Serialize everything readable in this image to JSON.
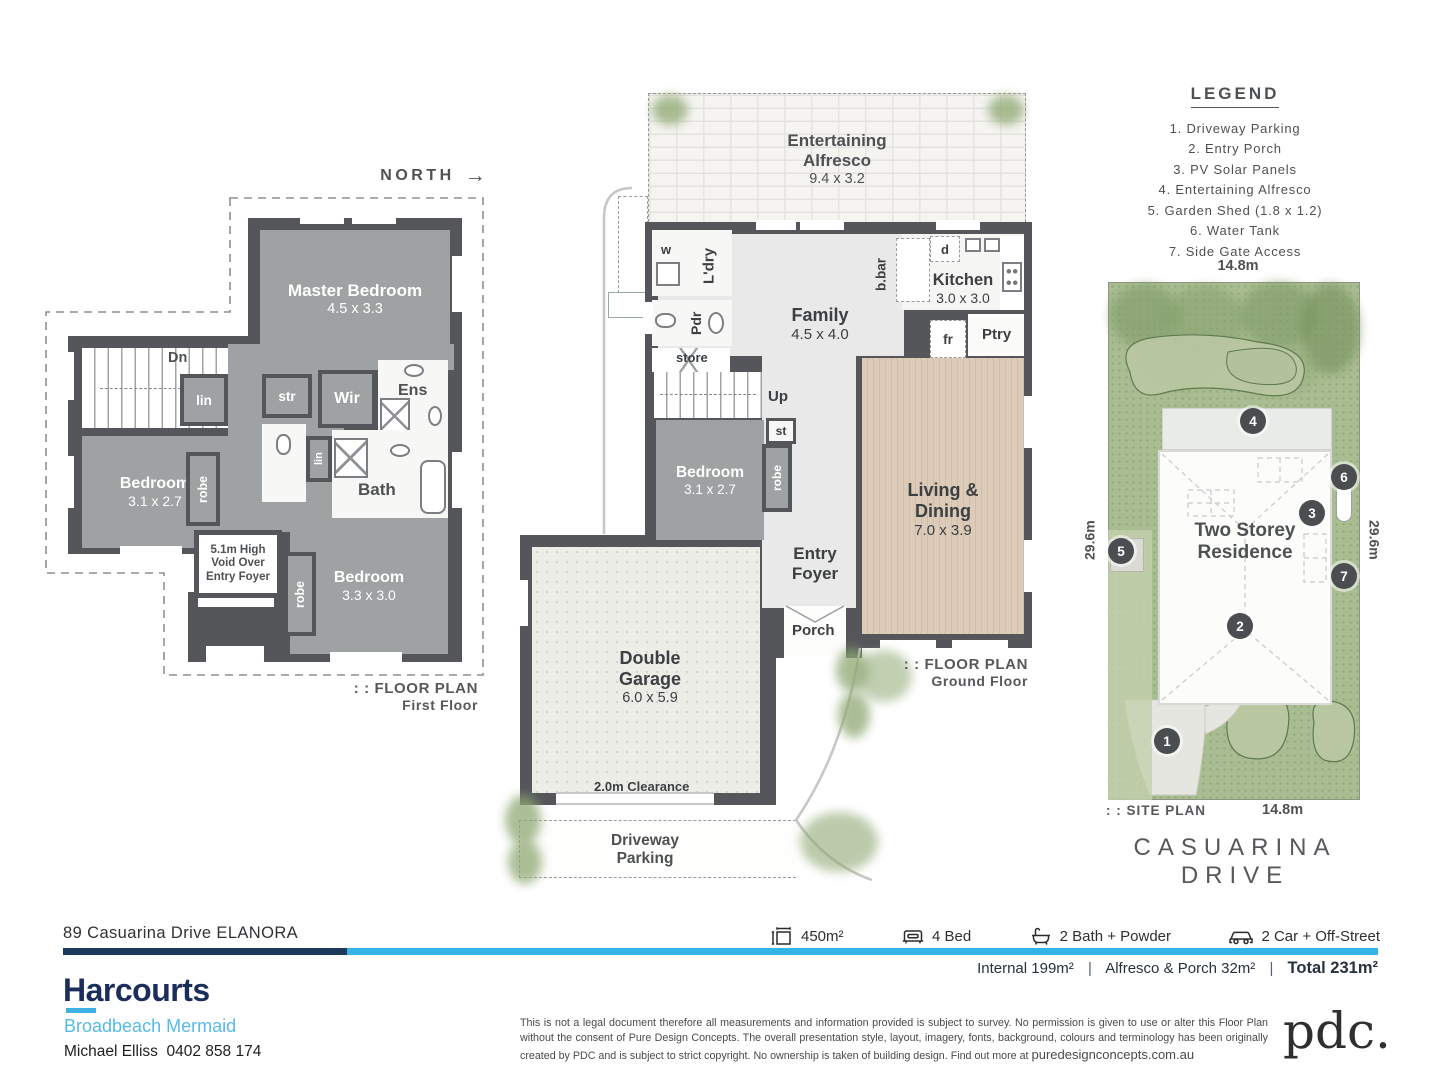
{
  "legend": {
    "title": "LEGEND",
    "items": [
      "1. Driveway Parking",
      "2. Entry Porch",
      "3. PV Solar Panels",
      "4. Entertaining Alfresco",
      "5. Garden Shed (1.8 x 1.2)",
      "6. Water Tank",
      "7. Side Gate Access"
    ]
  },
  "first_floor": {
    "north_label": "NORTH",
    "north_arrow": "→",
    "master_name": "Master Bedroom",
    "master_dim": "4.5 x 3.3",
    "dn": "Dn",
    "lin1": "lin",
    "str": "str",
    "wir": "Wir",
    "ens": "Ens",
    "bed1_name": "Bedroom",
    "bed1_dim": "3.1 x 2.7",
    "robe1": "robe",
    "lin2": "lin",
    "bath": "Bath",
    "void_l1": "5.1m High",
    "void_l2": "Void Over",
    "void_l3": "Entry Foyer",
    "bed2_name": "Bedroom",
    "bed2_dim": "3.3 x 3.0",
    "robe2": "robe",
    "plan_tag": ": : FLOOR PLAN",
    "plan_floor": "First Floor"
  },
  "ground_floor": {
    "alfresco_l1": "Entertaining",
    "alfresco_l2": "Alfresco",
    "alfresco_dim": "9.4 x 3.2",
    "w": "w",
    "ldry": "L'dry",
    "pdr": "Pdr",
    "store": "store",
    "family_name": "Family",
    "family_dim": "4.5 x 4.0",
    "bbar": "b.bar",
    "d": "d",
    "kitchen_name": "Kitchen",
    "kitchen_dim": "3.0 x 3.0",
    "fr": "fr",
    "ptry": "Ptry",
    "up": "Up",
    "st": "st",
    "robe": "robe",
    "bed_name": "Bedroom",
    "bed_dim": "3.1 x 2.7",
    "living_l1": "Living &",
    "living_l2": "Dining",
    "living_dim": "7.0 x 3.9",
    "entry_l1": "Entry",
    "entry_l2": "Foyer",
    "porch": "Porch",
    "garage_l1": "Double",
    "garage_l2": "Garage",
    "garage_dim": "6.0 x 5.9",
    "clearance": "2.0m Clearance",
    "driveway_l1": "Driveway",
    "driveway_l2": "Parking",
    "plan_tag": ": : FLOOR PLAN",
    "plan_floor": "Ground Floor"
  },
  "site_plan": {
    "width_top": "14.8m",
    "width_bottom": "14.8m",
    "depth_left": "29.6m",
    "depth_right": "29.6m",
    "residence_l1": "Two Storey",
    "residence_l2": "Residence",
    "markers": [
      "1",
      "2",
      "3",
      "4",
      "5",
      "6",
      "7"
    ],
    "plan_tag": ": : SITE PLAN",
    "street": "CASUARINA DRIVE"
  },
  "footer": {
    "address": "89 Casuarina Drive ELANORA",
    "stats": [
      {
        "icon": "land-size-icon",
        "label": "450m²"
      },
      {
        "icon": "bed-icon",
        "label": "4 Bed"
      },
      {
        "icon": "bath-icon",
        "label": "2 Bath + Powder"
      },
      {
        "icon": "car-icon",
        "label": "2 Car + Off-Street"
      }
    ],
    "area_internal": "Internal 199m²",
    "area_alfresco": "Alfresco & Porch 32m²",
    "area_total": "Total 231m²",
    "sep": "|",
    "brand": "Harcourts",
    "brand_sub": "Broadbeach Mermaid",
    "agent": "Michael Elliss  0402 858 174",
    "disclaimer": "This is not a legal document therefore all measurements and information provided is subject to survey. No permission is given to use or alter this Floor Plan without the consent of Pure Design Concepts. The overall presentation style, layout, imagery, fonts, background, colours and terminology has been originally created by PDC and is subject to strict copyright. No ownership is taken of building design. Find out more at ",
    "disclaimer_url": "puredesignconcepts.com.au",
    "pdc": "pdc."
  }
}
